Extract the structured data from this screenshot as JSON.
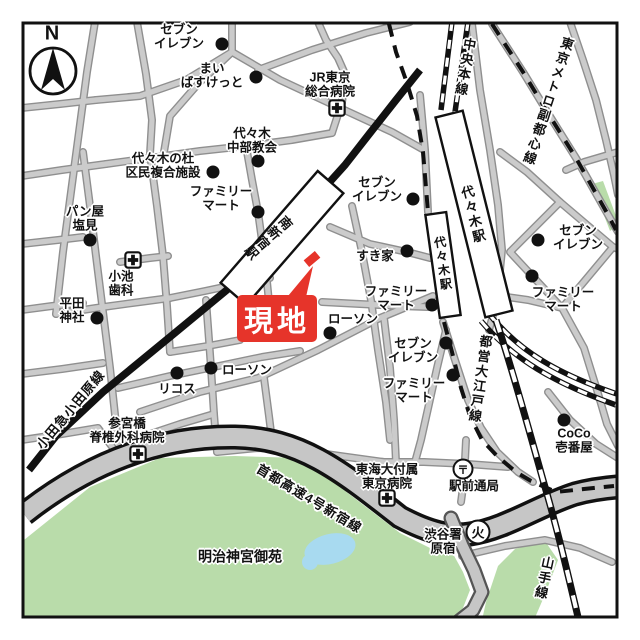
{
  "compass": {
    "label": "N"
  },
  "site": {
    "label": "現地"
  },
  "stations": {
    "minami_shinjuku": "南新宿駅",
    "yoyogi_jr": "代々木駅",
    "yoyogi_oedo": "代々木駅"
  },
  "lines": {
    "odakyu": "小田急小田原線",
    "chuo": "中央本線",
    "fukutoshin": "東京メトロ副都心線",
    "oedo": "都営大江戸線",
    "yamanote": "山手線",
    "shuto_expwy": "首都高速4号新宿線"
  },
  "areas": {
    "gyoen": "明治神宮御苑"
  },
  "pois": [
    {
      "name": "セブン\nイレブン"
    },
    {
      "name": "まい\nばすけっと"
    },
    {
      "name": "JR東京\n総合病院"
    },
    {
      "name": "代々木\n中部教会"
    },
    {
      "name": "代々木の杜\n区民複合施設"
    },
    {
      "name": "ファミリー\nマート"
    },
    {
      "name": "パン屋\n塩見"
    },
    {
      "name": "小池\n歯科"
    },
    {
      "name": "平田\n神社"
    },
    {
      "name": "セブン\nイレブン"
    },
    {
      "name": "すき家"
    },
    {
      "name": "ファミリー\nマート"
    },
    {
      "name": "ローソン"
    },
    {
      "name": "ローソン"
    },
    {
      "name": "リコス"
    },
    {
      "name": "セブン\nイレブン"
    },
    {
      "name": "ファミリー\nマート"
    },
    {
      "name": "セブン\nイレブン"
    },
    {
      "name": "ファミリー\nマート"
    },
    {
      "name": "CoCo\n壱番屋"
    },
    {
      "name": "東海大付属\n東京病院"
    },
    {
      "name": "駅前通局"
    },
    {
      "name": "渋谷署\n原宿"
    },
    {
      "name": "参宮橋\n脊椎外科病院"
    }
  ]
}
